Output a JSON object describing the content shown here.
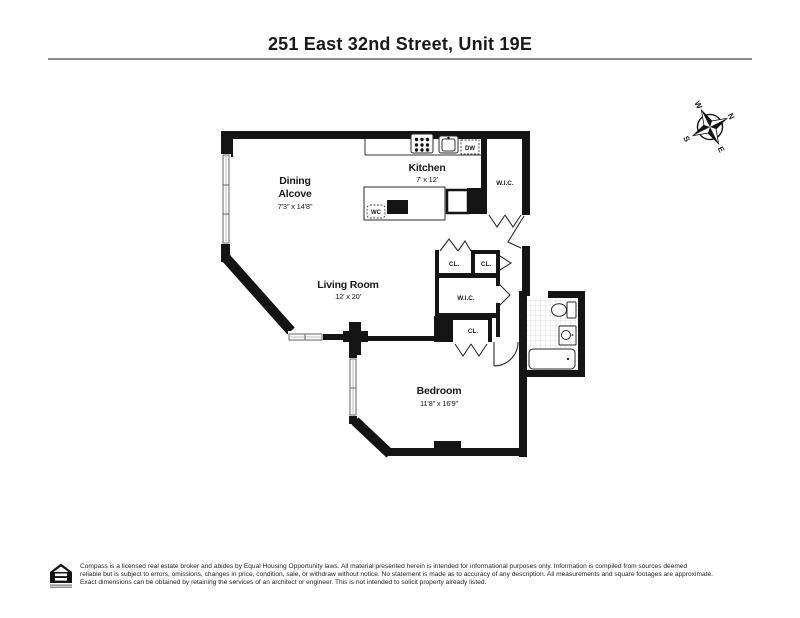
{
  "header": {
    "title": "251 East 32nd Street, Unit 19E"
  },
  "compass": {
    "north": "N",
    "south": "S",
    "east": "E",
    "west": "W"
  },
  "rooms": {
    "dining": {
      "name_line1": "Dining",
      "name_line2": "Alcove",
      "dims": "7'3\" x 14'8\""
    },
    "kitchen": {
      "name": "Kitchen",
      "dims": "7' x 12'"
    },
    "living_room": {
      "name": "Living Room",
      "dims": "12' x 20'"
    },
    "bedroom": {
      "name": "Bedroom",
      "dims": "11'8\" x 16'9\""
    },
    "walk_in_closet_top": "W.I.C.",
    "walk_in_closet_mid": "W.I.C.",
    "closet_1": "CL.",
    "closet_2": "CL.",
    "closet_3": "CL."
  },
  "appliances": {
    "dishwasher": "DW",
    "wine_cooler": "WC"
  },
  "colors": {
    "wall": "#141414",
    "text": "#1a1a1a",
    "tile": "#cccccc"
  },
  "footer": {
    "disclaimer_line1": "Compass is a licensed real estate broker and abides by Equal Housing Opportunity laws. All material presented herein is intended for informational purposes only. Information is compiled from sources deemed",
    "disclaimer_line2": "reliable but is subject to errors, omissions, changes in price, condition, sale, or withdraw without notice. No statement is made as to accuracy of any description. All measurements and square footages are approximate.",
    "disclaimer_line3": "Exact dimensions can be obtained by retaining the services of an architect or engineer. This is not intended to solicit property already listed."
  }
}
